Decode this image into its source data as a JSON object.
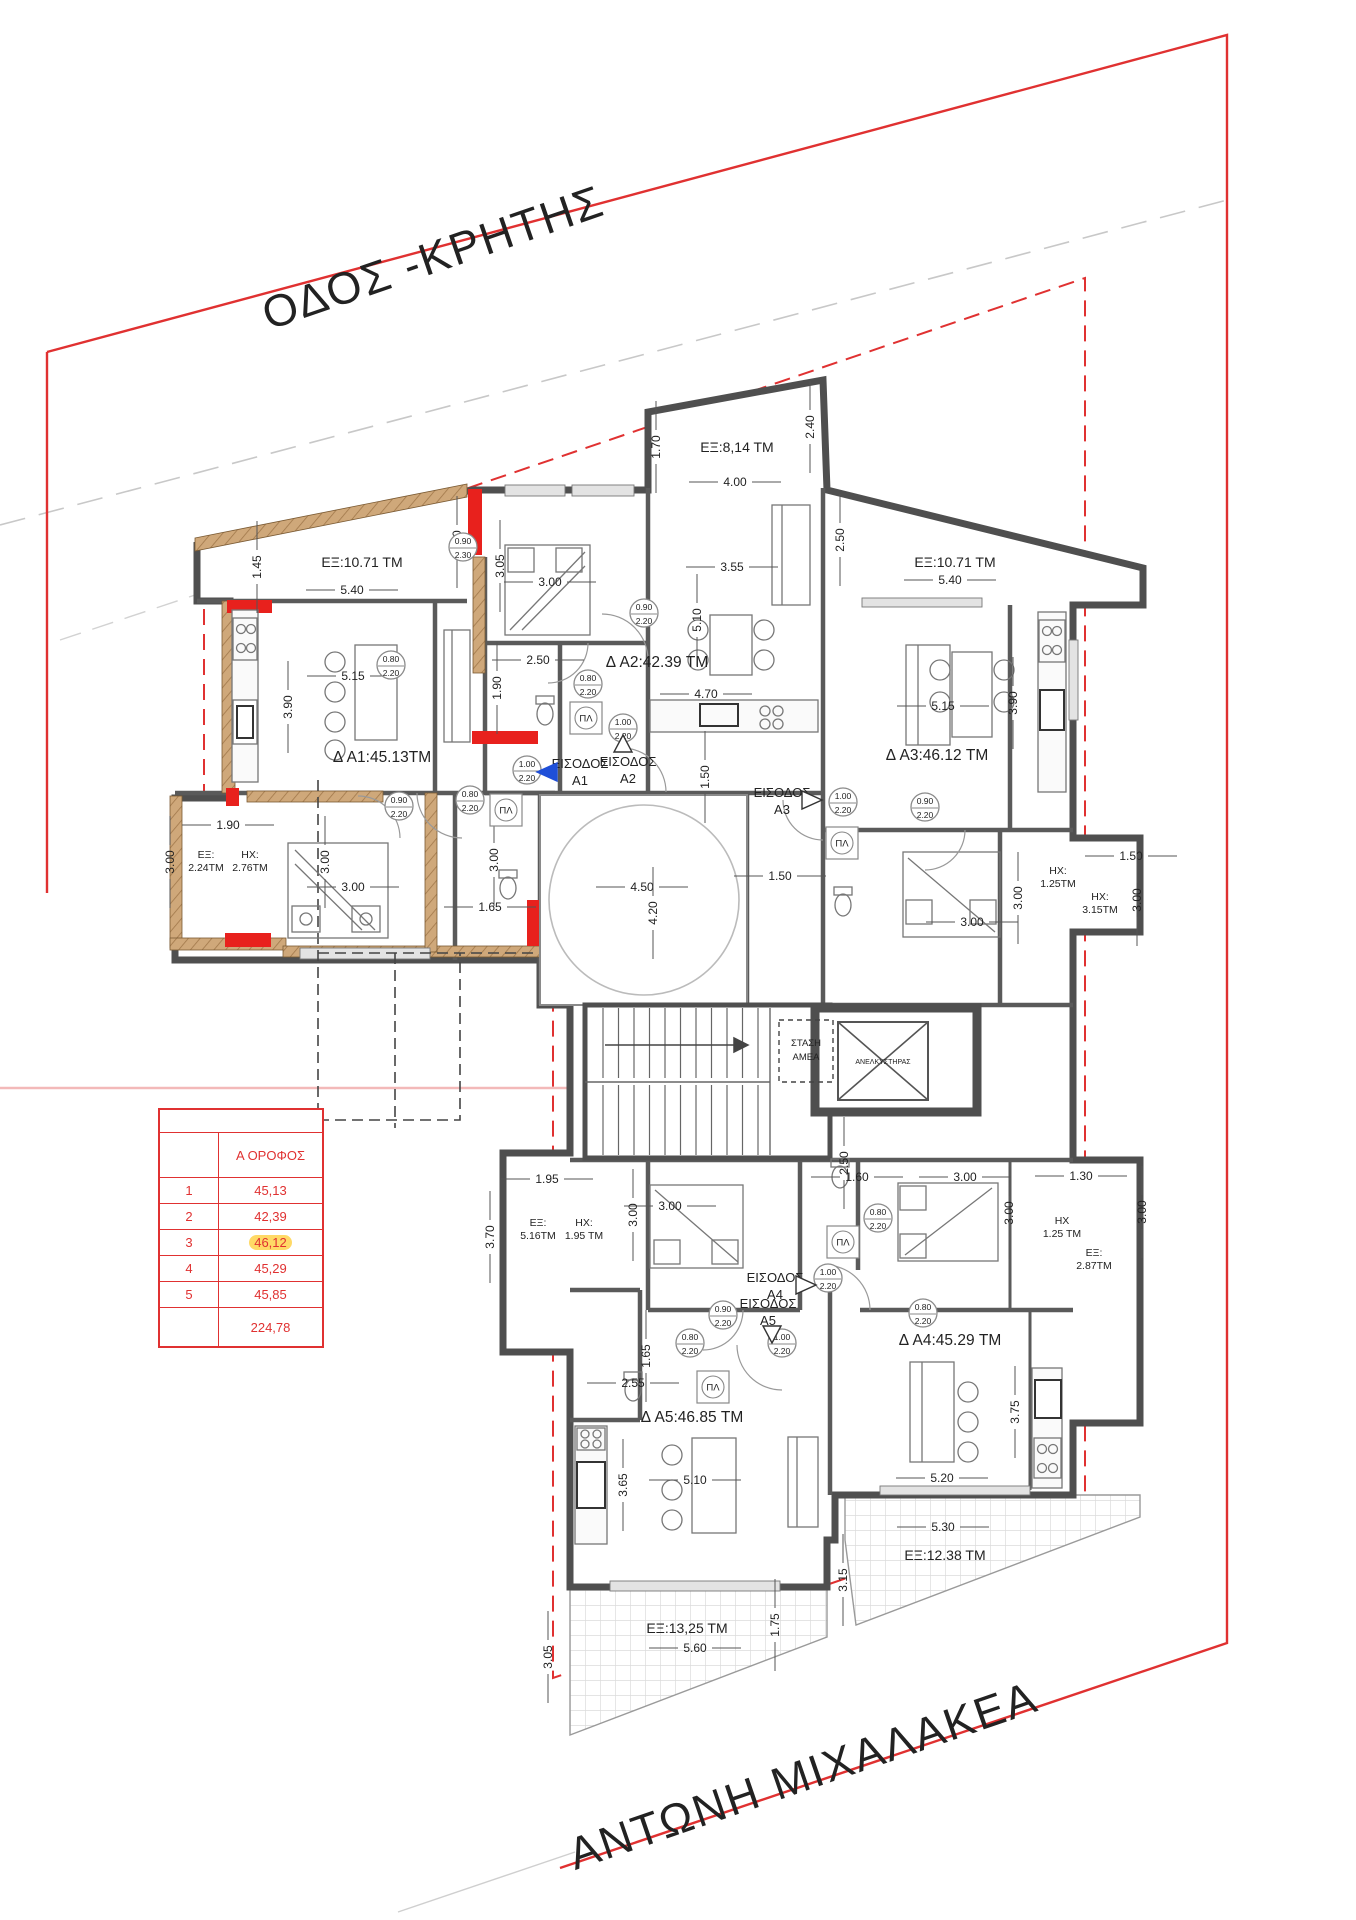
{
  "colors": {
    "boundary_red": "#e03131",
    "wall_dark": "#4f4f4f",
    "wood_tan": "#cfa87a",
    "pink_balcony": "#f7dede",
    "highlight_yellow": "#ffd966",
    "entrance_blue": "#1f4fd8"
  },
  "streets": [
    {
      "name": "ΟΔΟΣ -ΚΡΗΤΗΣ",
      "x": 438,
      "y": 272,
      "rotate": -19
    },
    {
      "name": "ΑΝΤΩΝΗ ΜΙΧΑΛΑΚΕΑ",
      "x": 808,
      "y": 1790,
      "rotate": -19
    }
  ],
  "area_table": {
    "col_header": "Α ΟΡΟΦΟΣ",
    "rows": [
      {
        "num": "1",
        "value": "45,13",
        "highlight": false
      },
      {
        "num": "2",
        "value": "42,39",
        "highlight": false
      },
      {
        "num": "3",
        "value": "46,12",
        "highlight": true
      },
      {
        "num": "4",
        "value": "45,29",
        "highlight": false
      },
      {
        "num": "5",
        "value": "45,85",
        "highlight": false
      }
    ],
    "total": "224,78"
  },
  "apartment_labels": [
    {
      "text": "Δ A1:45.13ΤΜ",
      "x": 382,
      "y": 762
    },
    {
      "text": "Δ A2:42.39 ΤΜ",
      "x": 657,
      "y": 667
    },
    {
      "text": "Δ A3:46.12 ΤΜ",
      "x": 937,
      "y": 760
    },
    {
      "text": "Δ A4:45.29 ΤΜ",
      "x": 950,
      "y": 1345
    },
    {
      "text": "Δ A5:46.85 ΤΜ",
      "x": 692,
      "y": 1422
    }
  ],
  "balcony_labels": [
    {
      "text": "ΕΞ:8,14 ΤΜ",
      "x": 737,
      "y": 447
    },
    {
      "text": "ΕΞ:10.71 ΤΜ",
      "x": 362,
      "y": 562
    },
    {
      "text": "ΕΞ:10.71 ΤΜ",
      "x": 955,
      "y": 562
    },
    {
      "text": "ΕΞ:13,25 ΤΜ",
      "x": 687,
      "y": 1628
    },
    {
      "text": "ΕΞ:12.38 ΤΜ",
      "x": 945,
      "y": 1555
    }
  ],
  "balcony_labels_2line": [
    {
      "line1": "ΕΞ:",
      "line2": "2.24ΤΜ",
      "x": 206,
      "y": 858
    },
    {
      "line1": "ΗΧ:",
      "line2": "2.76ΤΜ",
      "x": 250,
      "y": 858
    },
    {
      "line1": "ΕΞ:",
      "line2": "5.16ΤΜ",
      "x": 538,
      "y": 1226
    },
    {
      "line1": "ΗΧ:",
      "line2": "1.95 ΤΜ",
      "x": 584,
      "y": 1226
    },
    {
      "line1": "ΗΧ:",
      "line2": "1.25ΤΜ",
      "x": 1058,
      "y": 874
    },
    {
      "line1": "ΗΧ:",
      "line2": "3.15ΤΜ",
      "x": 1100,
      "y": 900
    },
    {
      "line1": "ΗΧ",
      "line2": "1.25 ΤΜ",
      "x": 1062,
      "y": 1224
    },
    {
      "line1": "ΕΞ:",
      "line2": "2.87ΤΜ",
      "x": 1094,
      "y": 1256
    }
  ],
  "dimensions": [
    {
      "t": "1.70",
      "x": 656,
      "y": 447,
      "v": true
    },
    {
      "t": "4.00",
      "x": 735,
      "y": 482
    },
    {
      "t": "2.40",
      "x": 810,
      "y": 427,
      "v": true
    },
    {
      "t": "1.45",
      "x": 257,
      "y": 567,
      "v": true
    },
    {
      "t": "5.40",
      "x": 352,
      "y": 590
    },
    {
      "t": "2.50",
      "x": 457,
      "y": 542,
      "v": true
    },
    {
      "t": "2.50",
      "x": 840,
      "y": 540,
      "v": true
    },
    {
      "t": "5.40",
      "x": 950,
      "y": 580
    },
    {
      "t": "5.15",
      "x": 353,
      "y": 676
    },
    {
      "t": "3.90",
      "x": 288,
      "y": 707,
      "v": true
    },
    {
      "t": "1.90",
      "x": 497,
      "y": 688,
      "v": true
    },
    {
      "t": "3.05",
      "x": 500,
      "y": 566,
      "v": true
    },
    {
      "t": "3.00",
      "x": 550,
      "y": 582
    },
    {
      "t": "2.50",
      "x": 538,
      "y": 660
    },
    {
      "t": "3.55",
      "x": 732,
      "y": 567
    },
    {
      "t": "5.10",
      "x": 697,
      "y": 620,
      "v": true
    },
    {
      "t": "4.70",
      "x": 706,
      "y": 694
    },
    {
      "t": "1.50",
      "x": 705,
      "y": 777,
      "v": true
    },
    {
      "t": "5.15",
      "x": 943,
      "y": 706
    },
    {
      "t": "3.90",
      "x": 1013,
      "y": 703,
      "v": true
    },
    {
      "t": "3.00",
      "x": 1018,
      "y": 898,
      "v": true
    },
    {
      "t": "3.00",
      "x": 972,
      "y": 922
    },
    {
      "t": "1.50",
      "x": 1131,
      "y": 856
    },
    {
      "t": "3.00",
      "x": 1137,
      "y": 900,
      "v": true
    },
    {
      "t": "1.50",
      "x": 780,
      "y": 876
    },
    {
      "t": "4.50",
      "x": 642,
      "y": 887
    },
    {
      "t": "4.20",
      "x": 653,
      "y": 913,
      "v": true
    },
    {
      "t": "1.65",
      "x": 490,
      "y": 907
    },
    {
      "t": "3.00",
      "x": 494,
      "y": 860,
      "v": true
    },
    {
      "t": "1.90",
      "x": 228,
      "y": 825
    },
    {
      "t": "3.00",
      "x": 170,
      "y": 862,
      "v": true
    },
    {
      "t": "3.00",
      "x": 325,
      "y": 862,
      "v": true
    },
    {
      "t": "3.00",
      "x": 353,
      "y": 887
    },
    {
      "t": "2.50",
      "x": 844,
      "y": 1163,
      "v": true
    },
    {
      "t": "1.60",
      "x": 857,
      "y": 1177
    },
    {
      "t": "3.00",
      "x": 965,
      "y": 1177
    },
    {
      "t": "1.30",
      "x": 1081,
      "y": 1176
    },
    {
      "t": "3.00",
      "x": 1009,
      "y": 1213,
      "v": true
    },
    {
      "t": "3.00",
      "x": 1142,
      "y": 1212,
      "v": true
    },
    {
      "t": "3.75",
      "x": 1015,
      "y": 1412,
      "v": true
    },
    {
      "t": "5.20",
      "x": 942,
      "y": 1478
    },
    {
      "t": "3.00",
      "x": 670,
      "y": 1206
    },
    {
      "t": "3.00",
      "x": 633,
      "y": 1215,
      "v": true
    },
    {
      "t": "1.65",
      "x": 646,
      "y": 1356,
      "v": true
    },
    {
      "t": "2.55",
      "x": 633,
      "y": 1383
    },
    {
      "t": "5.10",
      "x": 695,
      "y": 1480
    },
    {
      "t": "3.65",
      "x": 623,
      "y": 1485,
      "v": true
    },
    {
      "t": "1.95",
      "x": 547,
      "y": 1179
    },
    {
      "t": "3.70",
      "x": 490,
      "y": 1237,
      "v": true
    },
    {
      "t": "5.60",
      "x": 695,
      "y": 1648
    },
    {
      "t": "1.75",
      "x": 775,
      "y": 1625,
      "v": true
    },
    {
      "t": "3.05",
      "x": 548,
      "y": 1657,
      "v": true
    },
    {
      "t": "3.15",
      "x": 843,
      "y": 1580,
      "v": true
    },
    {
      "t": "5.30",
      "x": 943,
      "y": 1527
    }
  ],
  "door_tags": [
    {
      "w": "0.90",
      "h": "2.20",
      "x": 399,
      "y": 806
    },
    {
      "w": "0.80",
      "h": "2.20",
      "x": 470,
      "y": 800
    },
    {
      "w": "1.00",
      "h": "2.20",
      "x": 527,
      "y": 770
    },
    {
      "w": "0.80",
      "h": "2.20",
      "x": 588,
      "y": 684
    },
    {
      "w": "1.00",
      "h": "2.20",
      "x": 623,
      "y": 728
    },
    {
      "w": "0.90",
      "h": "2.20",
      "x": 644,
      "y": 613
    },
    {
      "w": "1.00",
      "h": "2.20",
      "x": 843,
      "y": 802
    },
    {
      "w": "0.90",
      "h": "2.20",
      "x": 925,
      "y": 807
    },
    {
      "w": "0.80",
      "h": "2.20",
      "x": 878,
      "y": 1218
    },
    {
      "w": "0.80",
      "h": "2.20",
      "x": 923,
      "y": 1313
    },
    {
      "w": "1.00",
      "h": "2.20",
      "x": 828,
      "y": 1278
    },
    {
      "w": "1.00",
      "h": "2.20",
      "x": 782,
      "y": 1343
    },
    {
      "w": "0.90",
      "h": "2.20",
      "x": 723,
      "y": 1315
    },
    {
      "w": "0.80",
      "h": "2.20",
      "x": 690,
      "y": 1343
    },
    {
      "w": "0.90",
      "h": "2.30",
      "x": 463,
      "y": 547
    },
    {
      "w": "0.80",
      "h": "2.20",
      "x": 391,
      "y": 665
    }
  ],
  "appliance_tags": [
    {
      "t": "ΠΛ",
      "x": 506,
      "y": 810
    },
    {
      "t": "ΠΛ",
      "x": 586,
      "y": 718
    },
    {
      "t": "ΠΛ",
      "x": 842,
      "y": 843
    },
    {
      "t": "ΠΛ",
      "x": 843,
      "y": 1242
    },
    {
      "t": "ΠΛ",
      "x": 713,
      "y": 1387
    }
  ],
  "entrances": [
    {
      "line1": "ΕΙΣΟΔΟΣ",
      "line2": "A1",
      "x": 580,
      "y": 768,
      "arrow": "left",
      "ax": 547,
      "ay": 772,
      "filled": true
    },
    {
      "line1": "ΕΙΣΟΔΟΣ",
      "line2": "A2",
      "x": 628,
      "y": 766,
      "arrow": "up",
      "ax": 623,
      "ay": 744,
      "filled": false
    },
    {
      "line1": "ΕΙΣΟΔΟΣ",
      "line2": "A3",
      "x": 782,
      "y": 797,
      "arrow": "right",
      "ax": 812,
      "ay": 800,
      "filled": false
    },
    {
      "line1": "ΕΙΣΟΔΟΣ",
      "line2": "A4",
      "x": 775,
      "y": 1282,
      "arrow": "right",
      "ax": 806,
      "ay": 1285,
      "filled": false
    },
    {
      "line1": "ΕΙΣΟΔΟΣ",
      "line2": "A5",
      "x": 768,
      "y": 1308,
      "arrow": "down",
      "ax": 772,
      "ay": 1334,
      "filled": false
    }
  ],
  "core_labels": {
    "stop_line1": "ΣΤΑΣΗ",
    "stop_line2": "ΑΜΕΑ",
    "elevator": "ΑΝΕΛΚΥΣΤΗΡΑΣ"
  }
}
